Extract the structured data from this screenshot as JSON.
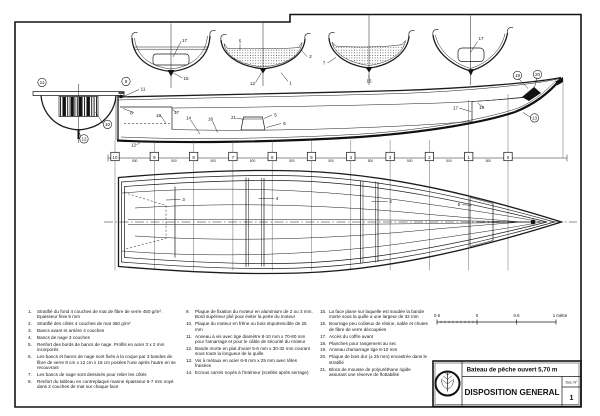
{
  "drawing": {
    "colors": {
      "ink": "#1b1b1b",
      "paper": "#ffffff"
    },
    "title_block": {
      "boat_title": "Bateau de pêche ouvert  5,70 m",
      "drawing_title": "DISPOSITION GENERAL",
      "sheet_label": "Des. N°",
      "sheet_number": "1"
    },
    "scale_bar": {
      "labels": [
        "0.5",
        "0",
        "0.5",
        "1 mètre"
      ]
    },
    "stations": {
      "numbers": [
        "10",
        "9",
        "8",
        "7",
        "6",
        "5",
        "4",
        "3",
        "2",
        "1",
        "0"
      ],
      "spacing": "500"
    },
    "legend_columns": [
      {
        "items": [
          {
            "n": "1.",
            "t": "Stratifié du fond 4 couches de mat de fibre de verre 450 g/m². Epaisseur finie 5 mm"
          },
          {
            "n": "2.",
            "t": "Stratifié des côtés 4 couches de mat 450 g/m²"
          },
          {
            "n": "3.",
            "t": "Bancs avant et arrière 4 couches"
          },
          {
            "n": "4.",
            "t": "Bancs de nage 3 couches"
          },
          {
            "n": "5.",
            "t": "Renfort des bords de bancs de nage. Profils en acier 3 x 2 mm incorporés"
          },
          {
            "n": "6.",
            "t": "Les bancs et bancs de nage sont fixés à la coque par 3 bandes de fibre de verre 8 cm x 12 cm x 16 cm posées l'une après l'autre en se recouvrant"
          },
          {
            "n": "7.",
            "t": "Les bancs de nage sont dessinés pour relier les côtés"
          },
          {
            "n": "8.",
            "t": "Renfort du tableau en contreplaqué marine épaisseur 6-7 mm noyé dans 2 couches de mat sur chaque face"
          }
        ]
      },
      {
        "items": [
          {
            "n": "9.",
            "t": "Plaque de fixation du moteur en aluminium de 2 ou 3 mm. Bord supérieur plié pour éviter la perte du moteur"
          },
          {
            "n": "10.",
            "t": "Plaque du moteur en frêne ou bois imputrescible de 25 mm"
          },
          {
            "n": "11.",
            "t": "Anneau à vis avec tige diamètre 8-10 mm x 70-80 mm pour l'amarrage et pour le câble de sécurité du moteur"
          },
          {
            "n": "12.",
            "t": "Bande morte en plat d'acier 5-6 mm x 30-32 mm courant sous toute la longueur de la quille"
          },
          {
            "n": "13.",
            "t": "Vis à métaux en acier 6-8 mm x 25 mm avec têtes fraisées"
          },
          {
            "n": "14.",
            "t": "Ecrous carrés noyés à l'intérieur (scellés après serrage)"
          }
        ]
      },
      {
        "items": [
          {
            "n": "15.",
            "t": "La face plane sur laquelle est soudée la bande morte sous la quille a une largeur de 32 mm"
          },
          {
            "n": "16.",
            "t": "Bourrage peu coûteux de résine, sable et chutes de fibre de verre découpées"
          },
          {
            "n": "17.",
            "t": "Accès du coffre avant"
          },
          {
            "n": "18.",
            "t": "Planches pour rangement au sec"
          },
          {
            "n": "19.",
            "t": "Anneau d'amarrage tige 8-10 mm"
          },
          {
            "n": "20.",
            "t": "Plaque de bois dur (± 25 mm) encastrée dans le stratifié"
          },
          {
            "n": "21.",
            "t": "Blocs de mousse de polyuréthane rigide assurant une réserve de flottabilité"
          }
        ]
      }
    ],
    "callouts": {
      "sections": [
        {
          "x": 184.5,
          "y": 42,
          "t": "17"
        },
        {
          "x": 186,
          "y": 80,
          "t": "15"
        },
        {
          "x": 240,
          "y": 42.5,
          "t": "5"
        },
        {
          "x": 310.5,
          "y": 58,
          "t": "2"
        },
        {
          "x": 252.5,
          "y": 85,
          "t": "12"
        },
        {
          "x": 290.5,
          "y": 84.5,
          "t": "1"
        },
        {
          "x": 324,
          "y": 64.5,
          "t": "7"
        },
        {
          "x": 369,
          "y": 82.5,
          "t": "15"
        },
        {
          "x": 481,
          "y": 40,
          "t": "17"
        }
      ],
      "transom": [
        {
          "x": 42,
          "y": 84,
          "t": "11",
          "c": 1
        },
        {
          "x": 107.5,
          "y": 126,
          "t": "10",
          "c": 1
        },
        {
          "x": 84,
          "y": 140.5,
          "t": "12",
          "c": 1
        }
      ],
      "side": [
        {
          "x": 126,
          "y": 83,
          "t": "9",
          "c": 1
        },
        {
          "x": 143,
          "y": 90.5,
          "t": "11"
        },
        {
          "x": 131.5,
          "y": 114.5,
          "t": "8"
        },
        {
          "x": 158.5,
          "y": 117,
          "t": "18"
        },
        {
          "x": 176.5,
          "y": 114,
          "t": "17"
        },
        {
          "x": 188.5,
          "y": 119.5,
          "t": "14"
        },
        {
          "x": 210.5,
          "y": 120.5,
          "t": "16"
        },
        {
          "x": 233.5,
          "y": 119,
          "t": "21"
        },
        {
          "x": 275.5,
          "y": 116.5,
          "t": "5"
        },
        {
          "x": 284.5,
          "y": 125,
          "t": "6"
        },
        {
          "x": 133.5,
          "y": 146.5,
          "t": "12"
        },
        {
          "x": 455.5,
          "y": 109.5,
          "t": "17"
        },
        {
          "x": 481.5,
          "y": 109,
          "t": "18"
        },
        {
          "x": 517.5,
          "y": 77,
          "t": "19",
          "c": 1
        },
        {
          "x": 537.5,
          "y": 76,
          "t": "20",
          "c": 1
        },
        {
          "x": 534.5,
          "y": 119.5,
          "t": "13",
          "c": 1
        }
      ],
      "plan": [
        {
          "x": 183.5,
          "y": 201,
          "t": "3"
        },
        {
          "x": 277,
          "y": 200,
          "t": "4"
        },
        {
          "x": 390.5,
          "y": 203,
          "t": "4"
        },
        {
          "x": 459,
          "y": 206,
          "t": "5"
        }
      ]
    }
  }
}
